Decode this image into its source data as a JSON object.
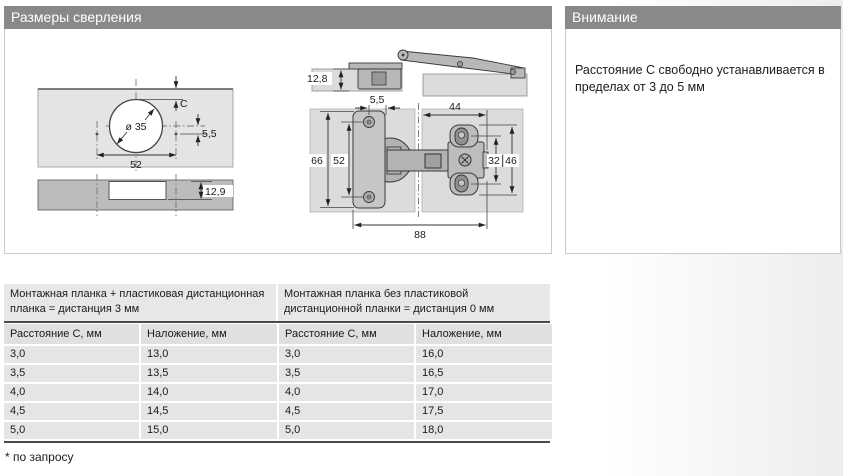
{
  "panels": {
    "drilling": {
      "title": "Размеры сверления"
    },
    "attention": {
      "title": "Внимание",
      "text": "Расстояние С свободно устанавливается в пределах от 3 до 5 мм"
    }
  },
  "drawing": {
    "front_view": {
      "cup_diameter": "ø 35",
      "distance_c": "C",
      "offset": "5,5",
      "hole_spacing": "52"
    },
    "edge_view": {
      "milling_depth": "12,9"
    },
    "side_view": {
      "cup_depth": "12,8"
    },
    "top_view": {
      "offset": "5,5",
      "arm_width": "44",
      "plate_height": "66",
      "hole_spacing": "52",
      "slot_spacing": "32",
      "plate_outer": "46",
      "total_length": "88"
    }
  },
  "table": {
    "group_headers": [
      "Монтажная планка + пластиковая дистанционная планка = дистанция 3 мм",
      "Монтажная планка без пластиковой дистанционной планки = дистанция 0 мм"
    ],
    "columns": [
      "Расстояние С, мм",
      "Наложение, мм",
      "Расстояние С, мм",
      "Наложение, мм"
    ],
    "rows": [
      [
        "3,0",
        "13,0",
        "3,0",
        "16,0"
      ],
      [
        "3,5",
        "13,5",
        "3,5",
        "16,5"
      ],
      [
        "4,0",
        "14,0",
        "4,0",
        "17,0"
      ],
      [
        "4,5",
        "14,5",
        "4,5",
        "17,5"
      ],
      [
        "5,0",
        "15,0",
        "5,0",
        "18,0"
      ]
    ]
  },
  "footnote": "* по запросу",
  "colors": {
    "header_bar": "#898989",
    "panel_border": "#c9c9c9",
    "wood_light": "#dcdcdc",
    "wood_dark": "#bcbcbc",
    "metal": "#b8b8b8",
    "table_row": "#e5e5e5",
    "table_rule": "#4a4a4a"
  }
}
